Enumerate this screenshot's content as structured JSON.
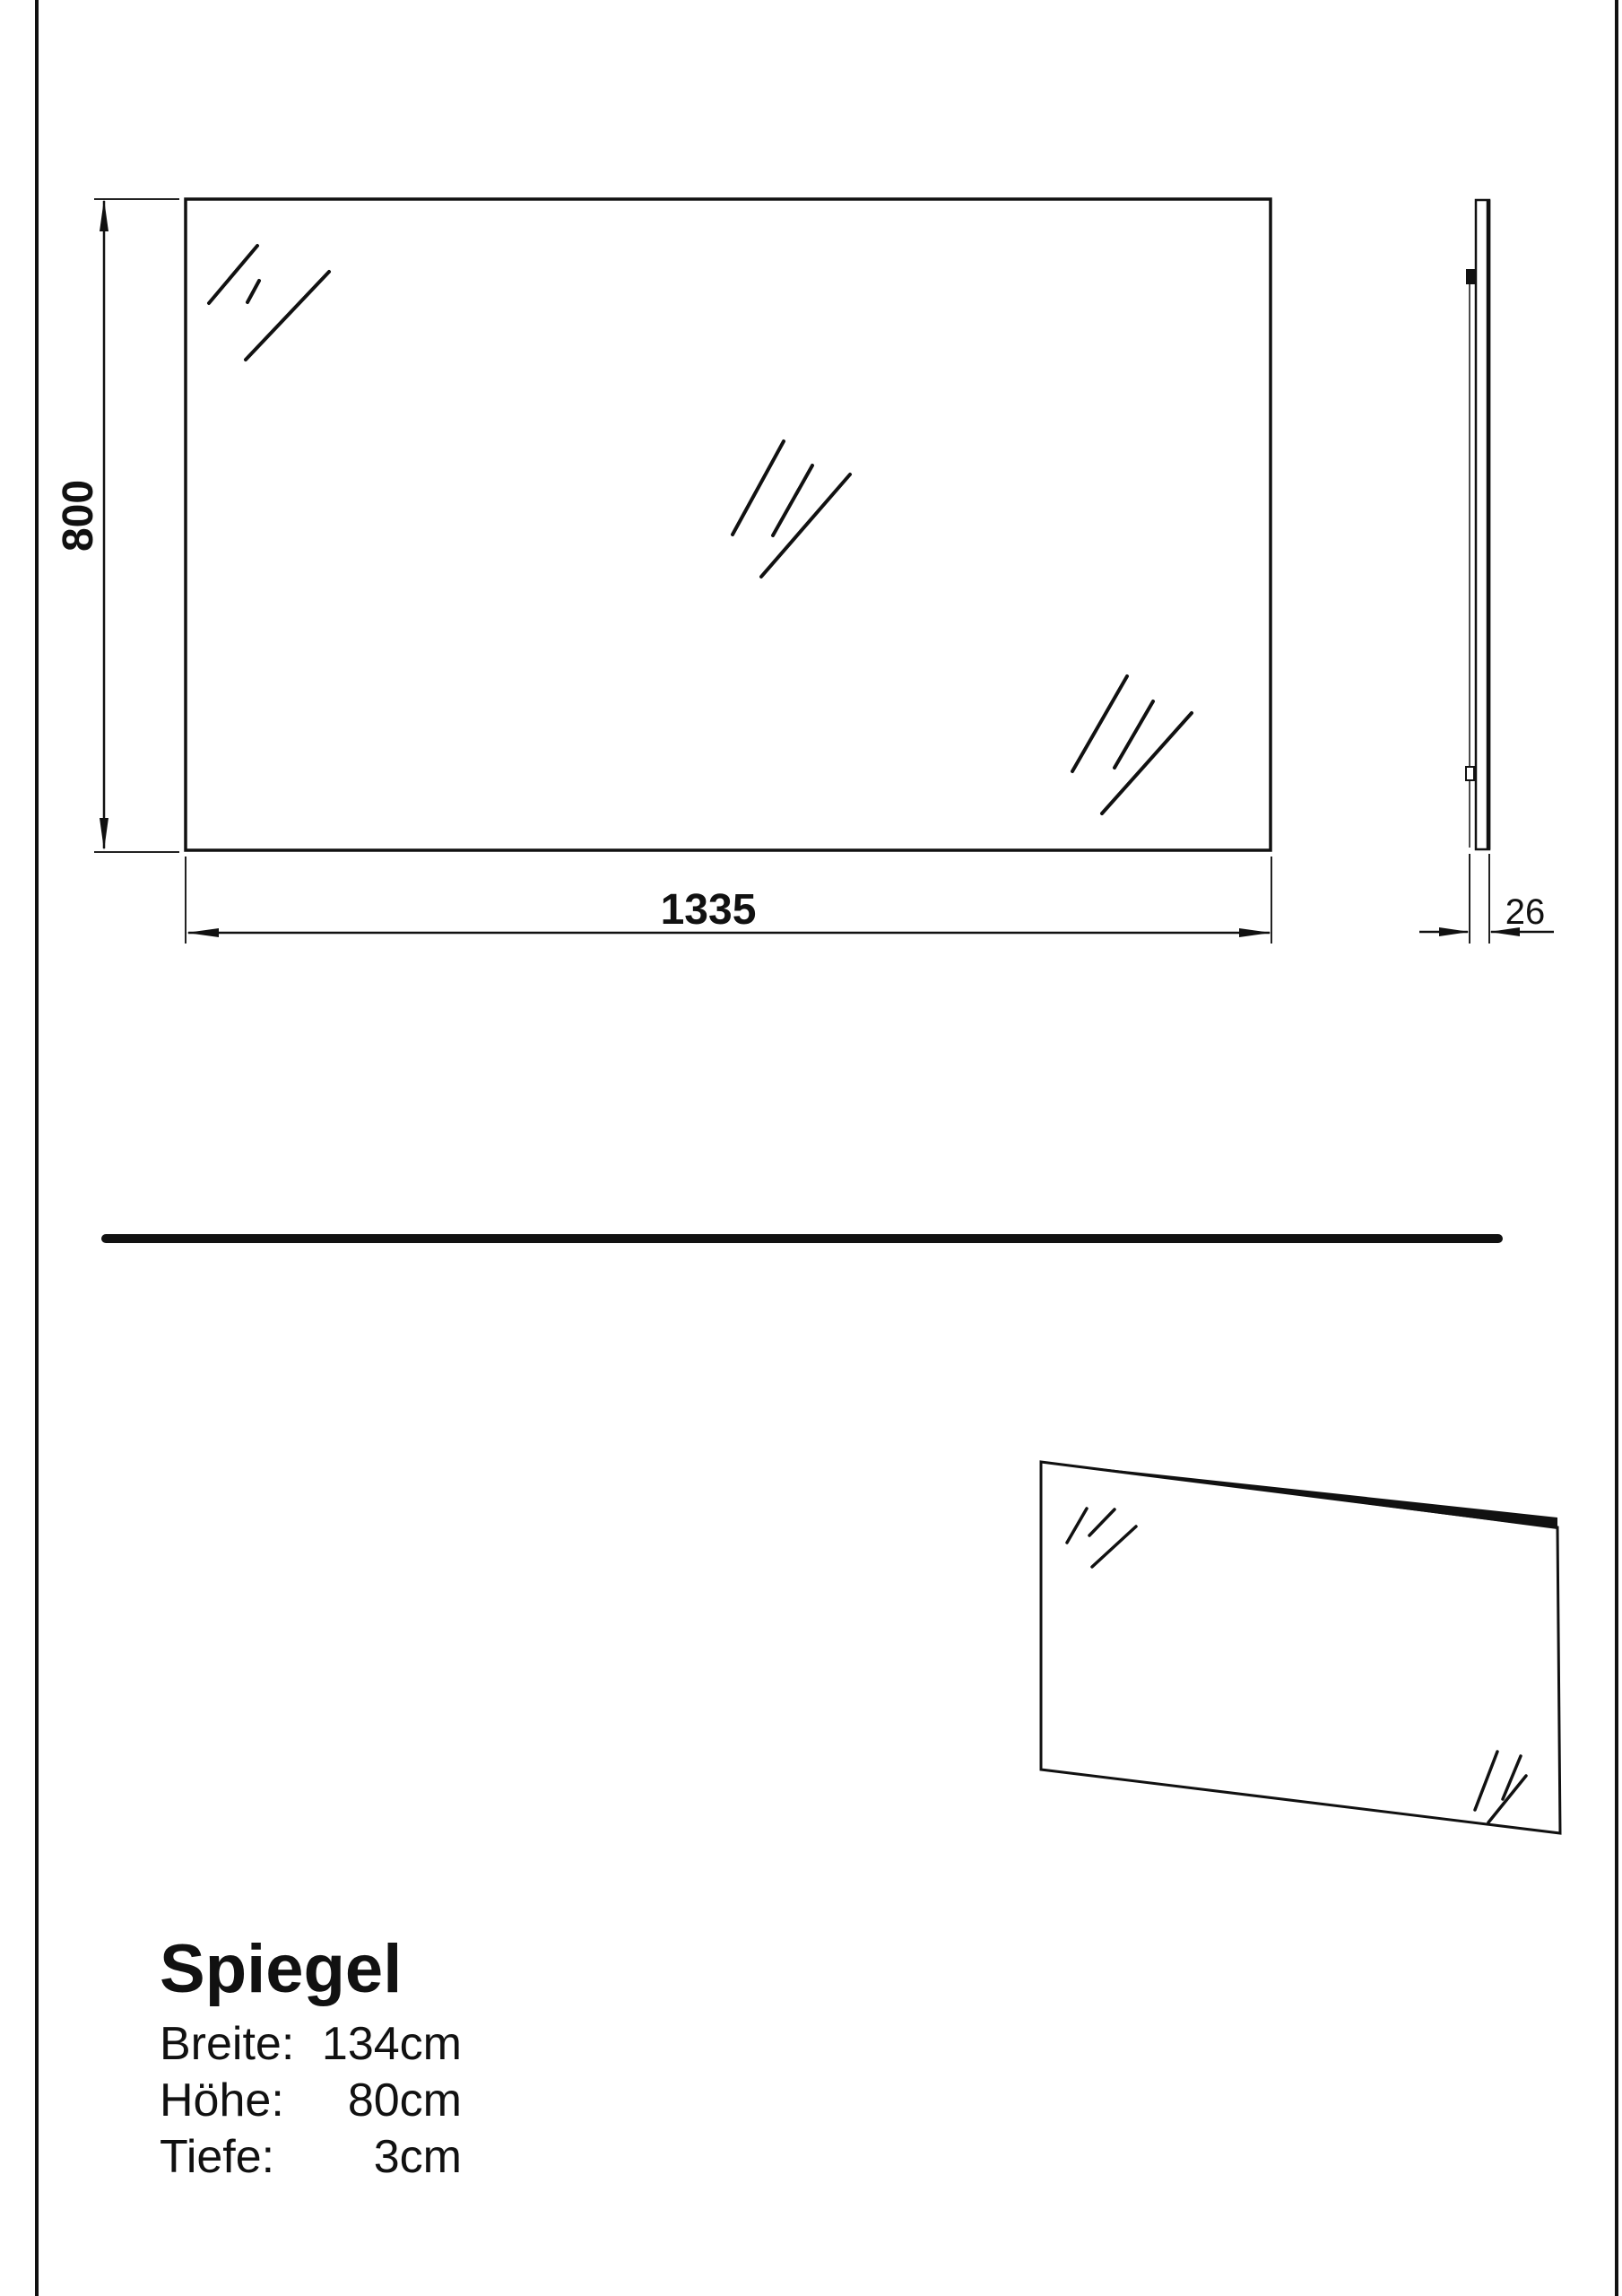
{
  "colors": {
    "ink": "#111111",
    "paper": "#ffffff"
  },
  "front_view": {
    "height_dim": "800",
    "width_dim": "1335"
  },
  "side_view": {
    "depth_dim": "26"
  },
  "specs": {
    "title": "Spiegel",
    "rows": [
      {
        "label": "Breite:",
        "value": "134cm"
      },
      {
        "label": "Höhe:",
        "value": "80cm"
      },
      {
        "label": "Tiefe:",
        "value": "3cm"
      }
    ]
  }
}
